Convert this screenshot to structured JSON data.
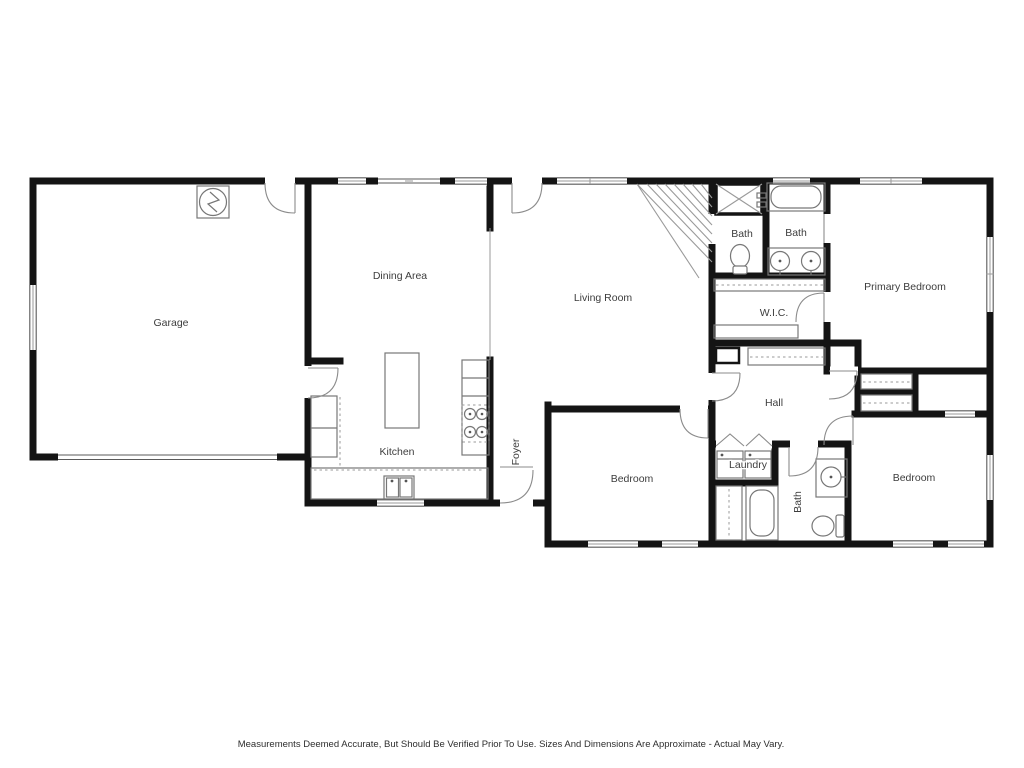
{
  "floor_plan": {
    "rooms": [
      {
        "id": "garage",
        "label": "Garage"
      },
      {
        "id": "dining-area",
        "label": "Dining Area"
      },
      {
        "id": "kitchen",
        "label": "Kitchen"
      },
      {
        "id": "living-room",
        "label": "Living Room"
      },
      {
        "id": "foyer",
        "label": "Foyer"
      },
      {
        "id": "bath-upper-left",
        "label": "Bath"
      },
      {
        "id": "bath-upper-right",
        "label": "Bath"
      },
      {
        "id": "wic",
        "label": "W.I.C."
      },
      {
        "id": "primary-bedroom",
        "label": "Primary Bedroom"
      },
      {
        "id": "hall",
        "label": "Hall"
      },
      {
        "id": "bedroom-middle",
        "label": "Bedroom"
      },
      {
        "id": "laundry",
        "label": "Laundry"
      },
      {
        "id": "bath-lower",
        "label": "Bath"
      },
      {
        "id": "bedroom-right",
        "label": "Bedroom"
      }
    ],
    "fixtures": [
      "water-heater",
      "stairs",
      "shower",
      "bathtub",
      "toilet",
      "double-sink-vanity",
      "closet-shelving",
      "washer",
      "dryer",
      "kitchen-island",
      "range",
      "kitchen-sink",
      "refrigerator",
      "garage-door",
      "window",
      "door"
    ],
    "disclaimer": "Measurements Deemed Accurate, But Should Be Verified Prior To Use. Sizes And Dimensions Are Approximate - Actual May Vary.",
    "colors": {
      "wall": "#141414",
      "window_line": "#5a5a5a",
      "fixture_line": "#777777",
      "light_line": "#9a9a9a",
      "label_text": "#3d3d3d",
      "disclaimer_text": "#2e2e2e",
      "background": "#ffffff"
    }
  }
}
